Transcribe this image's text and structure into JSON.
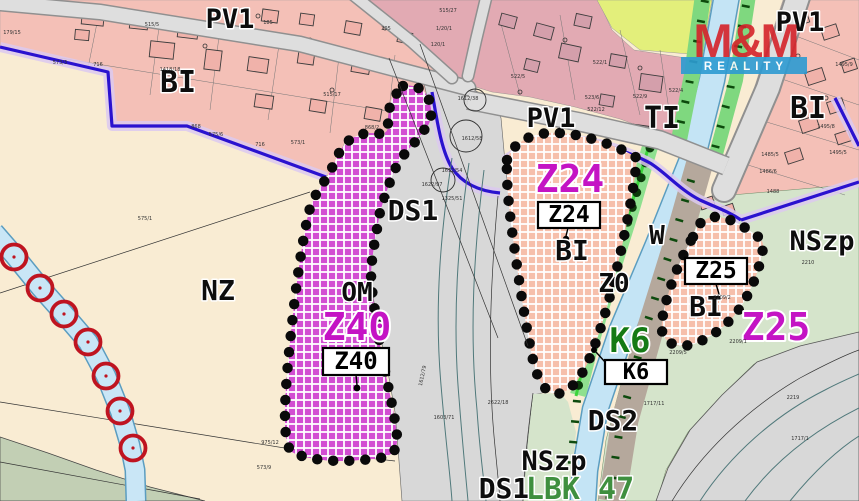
{
  "labels": {
    "pv1_top": "PV1",
    "pv1_mid": "PV1",
    "pv1_right": "PV1",
    "bi_topleft": "BI",
    "bi_right": "BI",
    "bi_z24": "BI",
    "bi_z25": "BI",
    "nz": "NZ",
    "om": "OM",
    "ti": "TI",
    "w": "W",
    "zo": "Z0",
    "ds1_mid": "DS1",
    "ds1_bottom": "DS1",
    "ds2": "DS2",
    "nszp_right": "NSzp",
    "nszp_bottom": "NSzp",
    "k6": "K6",
    "lbk": "LBK 47",
    "z40_big": "Z40",
    "z24_big": "Z24",
    "z25_big": "Z25"
  },
  "boxes": {
    "z40": "Z40",
    "z24": "Z24",
    "z25": "Z25",
    "k6": "K6"
  },
  "watermark": {
    "brand": "M&M",
    "reality": "REALITY",
    "red": "#d5232a",
    "blue": "#2d9bd2"
  },
  "colors": {
    "cream_nz": "#f9ecd3",
    "pink_bi": "#f4c0b7",
    "dusty_pink": "#e2aab3",
    "magenta_hatch": "#d24ed2",
    "salmon_hatch": "#f6bfab",
    "sage_nszp": "#d5e4cb",
    "sage_band": "#c2cfb4",
    "yellow_green": "#e3ef7b",
    "road_gray": "#dedede",
    "corridor_gray": "#d8d8d8",
    "taupe_ds2": "#b5a89c",
    "water_blue": "#c4e4f5",
    "k6_green": "#8fe08f",
    "boundary_blue": "#2a12cf",
    "boundary_halo": "#dcc9f0",
    "zone_magenta_text": "#c414c4",
    "k6_text_green": "#157a15",
    "red_marker": "#bf1420",
    "dot_black": "#0a0a0a"
  },
  "parcels": [
    {
      "t": "179/15",
      "x": 12,
      "y": 34
    },
    {
      "t": "515/5",
      "x": 152,
      "y": 26
    },
    {
      "t": "185",
      "x": 268,
      "y": 24
    },
    {
      "t": "205",
      "x": 386,
      "y": 30
    },
    {
      "t": "716",
      "x": 98,
      "y": 66
    },
    {
      "t": "868",
      "x": 196,
      "y": 128
    },
    {
      "t": "716",
      "x": 260,
      "y": 146
    },
    {
      "t": "1418/18",
      "x": 170,
      "y": 71
    },
    {
      "t": "515/17",
      "x": 332,
      "y": 96
    },
    {
      "t": "868/2",
      "x": 372,
      "y": 129
    },
    {
      "t": "575/1",
      "x": 145,
      "y": 220
    },
    {
      "t": "575/6",
      "x": 216,
      "y": 136
    },
    {
      "t": "573/3",
      "x": 60,
      "y": 64
    },
    {
      "t": "573/1",
      "x": 298,
      "y": 144
    },
    {
      "t": "975/12",
      "x": 270,
      "y": 444
    },
    {
      "t": "573/9",
      "x": 264,
      "y": 469
    },
    {
      "t": "515/27",
      "x": 448,
      "y": 12
    },
    {
      "t": "1/20/1",
      "x": 444,
      "y": 30
    },
    {
      "t": "120/1",
      "x": 438,
      "y": 46
    },
    {
      "t": "1612/38",
      "x": 468,
      "y": 100
    },
    {
      "t": "1612/58",
      "x": 472,
      "y": 140
    },
    {
      "t": "1622/97",
      "x": 432,
      "y": 186
    },
    {
      "t": "1612/54",
      "x": 452,
      "y": 172
    },
    {
      "t": "1325/51",
      "x": 452,
      "y": 200
    },
    {
      "t": "1612/79",
      "x": 424,
      "y": 376,
      "r": -78
    },
    {
      "t": "1603/71",
      "x": 444,
      "y": 419
    },
    {
      "t": "2622/18",
      "x": 498,
      "y": 404
    },
    {
      "t": "522/5",
      "x": 518,
      "y": 78
    },
    {
      "t": "522/1",
      "x": 600,
      "y": 64
    },
    {
      "t": "523/6",
      "x": 592,
      "y": 99
    },
    {
      "t": "522/12",
      "x": 596,
      "y": 111
    },
    {
      "t": "522/9",
      "x": 640,
      "y": 98
    },
    {
      "t": "522/4",
      "x": 676,
      "y": 92
    },
    {
      "t": "1495/9",
      "x": 844,
      "y": 66
    },
    {
      "t": "1495/8",
      "x": 826,
      "y": 128
    },
    {
      "t": "1495/5",
      "x": 838,
      "y": 154
    },
    {
      "t": "1485/5",
      "x": 770,
      "y": 156
    },
    {
      "t": "1486/6",
      "x": 768,
      "y": 173
    },
    {
      "t": "1488",
      "x": 773,
      "y": 193
    },
    {
      "t": "2210",
      "x": 808,
      "y": 264
    },
    {
      "t": "2209/2",
      "x": 722,
      "y": 299
    },
    {
      "t": "2209/1",
      "x": 738,
      "y": 343
    },
    {
      "t": "2209/5",
      "x": 678,
      "y": 354
    },
    {
      "t": "1717/11",
      "x": 654,
      "y": 405
    },
    {
      "t": "2219",
      "x": 793,
      "y": 399
    },
    {
      "t": "1717/1",
      "x": 800,
      "y": 440
    }
  ]
}
